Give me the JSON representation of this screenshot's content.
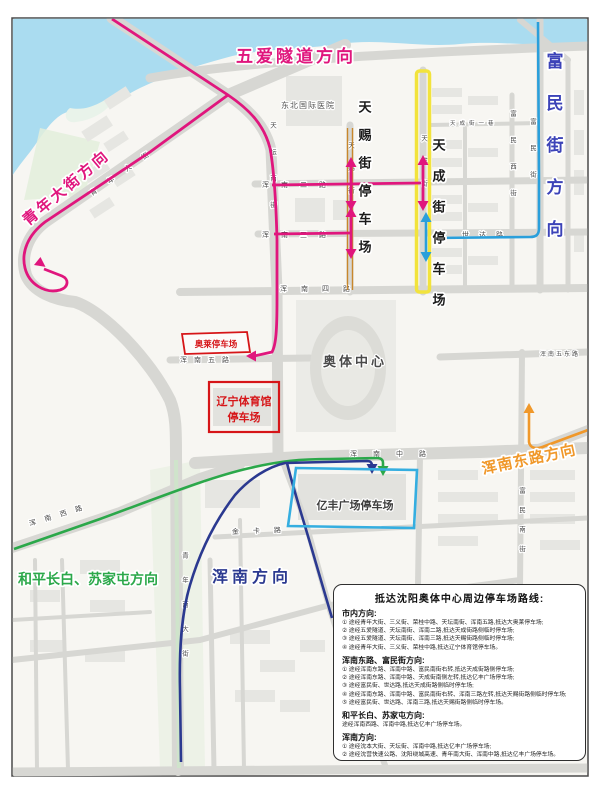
{
  "colors": {
    "route_pink": "#e0167d",
    "route_blue": "#2a9fdb",
    "route_green": "#2ba84a",
    "route_navy": "#2b3990",
    "route_orange": "#f0982a",
    "highlight_yellow": "#f2e33c",
    "highlight_orange": "#c8872b",
    "box_red": "#d61518",
    "box_blue": "#35aee0",
    "label_pink": "#e0167d",
    "label_blueviolet": "#3c43b8",
    "label_green": "#2ba84a",
    "label_navy": "#2b3990",
    "label_orange": "#f0982a"
  },
  "map": {
    "direction_labels": {
      "wuai_tunnel": "五爱隧道方向",
      "qingnian_street": "青年大街方向",
      "fumin_street": "富民街方向",
      "hunnan_east_road": "浑南东路方向",
      "heping_changbai": "和平长白、苏家屯方向",
      "hunnan": "浑南方向"
    },
    "parking": {
      "aolai": "奥莱停车场",
      "liaoning_gym_line1": "辽宁体育馆",
      "liaoning_gym_line2": "停车场",
      "tianci_street": "天赐街停车场",
      "tiancheng_street": "天成街停车场",
      "yifeng_plaza": "亿丰广场停车场"
    },
    "poi": {
      "hospital": "东北国际医院",
      "olympic_center": "奥体中心"
    },
    "streets": {
      "hunnan_2": "浑南二路",
      "hunnan_3": "浑南三路",
      "hunnan_4": "浑南四路",
      "hunnan_5": "浑南五路",
      "hunnan_5_east": "浑南五东路",
      "hunnan_middle": "浑南中路",
      "hunnan_west": "浑南西路",
      "shida": "世达路",
      "jinka": "金卡路",
      "tiantan_south": "天坛南街",
      "tianci": "天赐街",
      "tiancheng": "天成街",
      "tiancheng_lane": "天成街一巷",
      "fumin_west": "富民西街",
      "fumin": "富民街",
      "fumin_south": "富民南街",
      "qingnian": "青年大街",
      "qingnian_south": "青年南大街"
    }
  },
  "legend": {
    "title": "抵达沈阳奥体中心周边停车场路线:",
    "sections": [
      {
        "heading": "市内方向:",
        "items": [
          "① 途经青年大街、三义街、荣桂中路、天坛南街、浑南五路,抵达大奥莱停车场;",
          "② 途经五爱隧道、天坛南街、浑南二路,抵达天成街路侧临时停车场;",
          "③ 途经五爱隧道、天坛南街、浑南三路,抵达天赐街路侧临时停车场;",
          "④ 途经青年大街、三义街、荣桂中路,抵达辽宁体育馆停车场。"
        ]
      },
      {
        "heading": "浑南东路、富民街方向:",
        "items": [
          "① 途经浑南东路、浑南中路、富民南街右转,抵达天成街路侧停车场;",
          "② 途经浑南东路、浑南中路、天成街南侧左转,抵达亿丰广场停车场;",
          "③ 途经富民街、世达路,抵达天成街路侧临时停车场;",
          "④ 途经浑南东路、浑南中路、富民南街右转、浑南三路左转,抵达天赐街路侧临时停车场;",
          "⑤ 途经富民街、世达路、浑南三路,抵达天赐街路侧临时停车场。"
        ]
      },
      {
        "heading": "和平长白、苏家屯方向:",
        "items": [
          "途经浑南西路、浑南中路,抵达亿丰广场停车场。"
        ]
      },
      {
        "heading": "浑南方向:",
        "items": [
          "① 途经沈本大街、天坛街、浑南中路,抵达亿丰广场停车场;",
          "② 途经沈营快速公路、沈阳绕城高速、青年南大街、浑南中路,抵达亿丰广场停车场。"
        ]
      }
    ]
  }
}
